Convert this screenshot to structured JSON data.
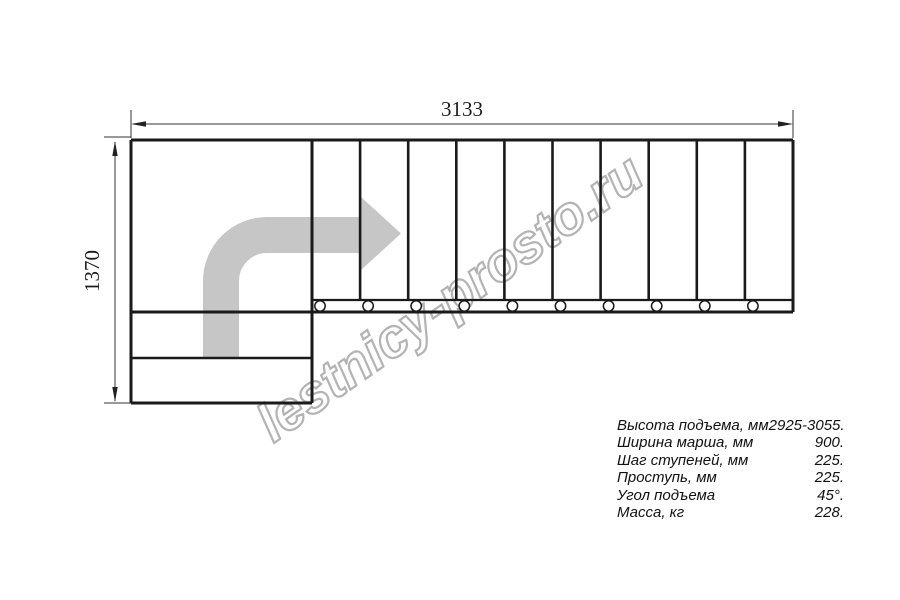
{
  "dimensions": {
    "width_label": "3133",
    "height_label": "1370"
  },
  "watermark": {
    "text": "lestnicy-prosto.ru",
    "color": "#b3b3b3"
  },
  "drawing": {
    "tread_count": 10,
    "line_color": "#1a1a1a",
    "arrow_color": "#c6c6c6"
  },
  "specs": {
    "rows": [
      {
        "label": "Высота подъема, мм",
        "value": "2925-3055."
      },
      {
        "label": "Ширина марша, мм",
        "value": "900."
      },
      {
        "label": "Шаг ступеней, мм",
        "value": "225."
      },
      {
        "label": "Проступь, мм",
        "value": "225."
      },
      {
        "label": "Угол подъема",
        "value": "45°."
      },
      {
        "label": "Масса, кг",
        "value": "228."
      }
    ]
  }
}
